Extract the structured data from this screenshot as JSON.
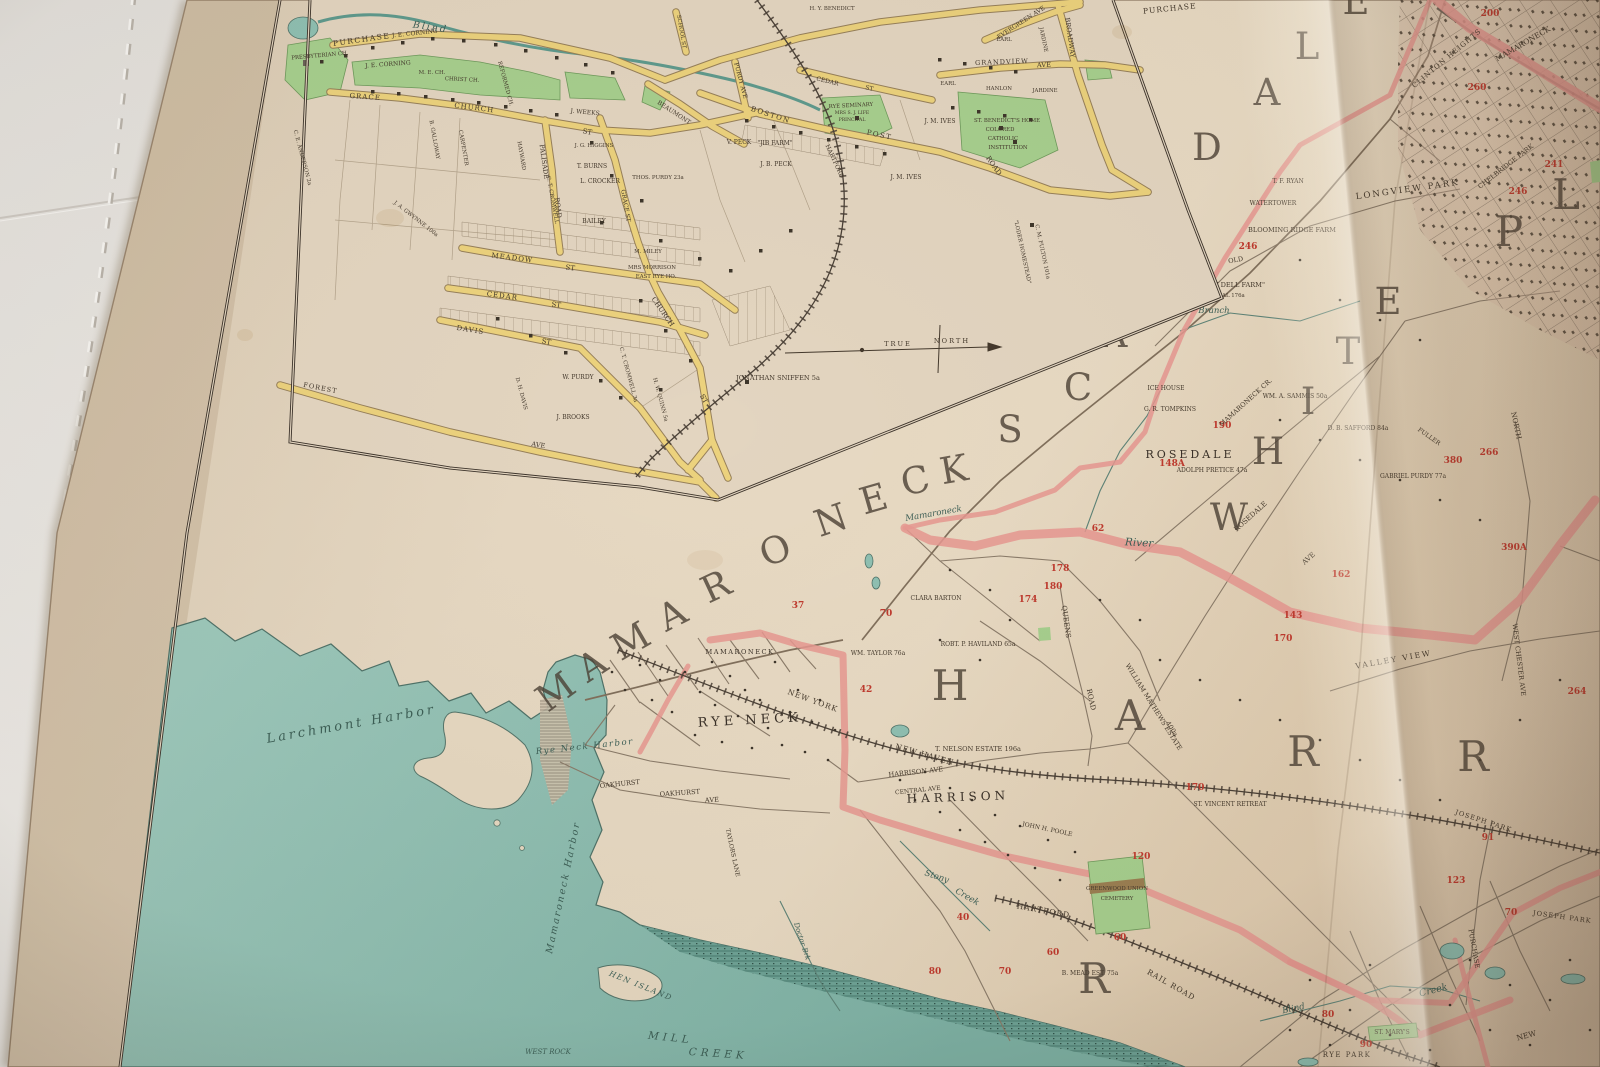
{
  "palette": {
    "sheet_white": "#e9e6e1",
    "page_cream": "#e5d7c1",
    "water_teal": "#93c2b4",
    "road_yellow": "#ecd27d",
    "park_green": "#a7cf8e",
    "boundary_pink": "#e69890",
    "ink": "#44392c",
    "plate_red": "#bf3a2e"
  },
  "inset": {
    "streets": [
      "PURCHASE",
      "PURCHASE",
      "GRACE",
      "CHURCH",
      "ST",
      "BEAUMONT",
      "PALISADE",
      "ROAD",
      "MEADOW",
      "ST",
      "CEDAR",
      "ST",
      "DAVIS",
      "ST",
      "FOREST",
      "AVE",
      "CHURCH",
      "ST",
      "GRACE ST",
      "BOSTON",
      "POST",
      "ROAD",
      "CEDAR",
      "ST",
      "PURDY AVE",
      "GRANDVIEW",
      "AVE",
      "EVERGREEN AVE",
      "BROADWAY",
      "HARTFORD",
      "SCHOOL ST"
    ],
    "places": [
      "PRESBYTERIAN CH.",
      "J. E. CORNING",
      "J. E. CORNING",
      "M. E. CH.",
      "CHRIST CH.",
      "REFORMED CH.",
      "J. WEEKS",
      "J. G. HIGGINS",
      "T. BURNS",
      "L. CROCKER",
      "BAILEY",
      "THOS. PURDY 23a",
      "C. T. CROMWELL",
      "HAYWARD",
      "CARPENTER",
      "B. GALLOWAY",
      "C. E. ANDERSON 2a",
      "J. A. GWYNNE 100a",
      "W. PURDY",
      "J. BROOKS",
      "D. H. DAVIS",
      "C. T. CROMWELL 3a",
      "H. W. QUINN 5a",
      "JONATHAN SNIFFEN 5a",
      "V. PECK",
      "\"JIB FARM\"",
      "J. B. PECK",
      "J. M. IVES",
      "J. M. IVES",
      "RYE SEMINARY",
      "MRS S. J. LIFE",
      "PRINCIPAL",
      "ST. BENEDICT'S HOME",
      "COLORED",
      "CATHOLIC",
      "INSTITUTION",
      "EARL",
      "EARL",
      "HANLON",
      "JARDINE",
      "JARDINE",
      "H. Y. BENEDICT",
      "\"LODER HOMESTEAD\"",
      "C. M. FULTON 101a",
      "M. MILEY",
      "MRS MORRISON",
      "EAST RYE HO.",
      "TRUE",
      "NORTH",
      "Blind"
    ]
  },
  "main": {
    "big": {
      "mamaroneck": [
        "M",
        "A",
        "M",
        "A",
        "R",
        "O",
        "N",
        "E",
        "C",
        "K"
      ],
      "scarsdale": [
        "S",
        "C",
        "A",
        "R",
        "S",
        "D",
        "A",
        "L",
        "E"
      ],
      "white": [
        "W",
        "H",
        "I",
        "T",
        "E"
      ],
      "plains": [
        "P",
        "L"
      ],
      "harrison": [
        "H",
        "A",
        "R",
        "R"
      ],
      "rye": [
        "R"
      ]
    },
    "towns": [
      "RYE NECK",
      "HARRISON",
      "ROSEDALE",
      "MAMARONECK"
    ],
    "water": [
      "Larchmont Harbor",
      "Rye Neck Harbor",
      "Mamaroneck Harbor",
      "MILL",
      "CREEK",
      "WEST ROCK",
      "HEN ISLAND",
      "Mamaroneck",
      "River",
      "Stony",
      "Creek",
      "Doctor Brk",
      "Blind",
      "Creek",
      "Branch",
      "MAMARONECK CR.",
      "MAMARONECK"
    ],
    "roads": [
      "NEW YORK",
      "NEW HAVEN",
      "HARTFORD",
      "RAIL ROAD",
      "NEW",
      "QUEENS",
      "ROAD",
      "ROSEDALE",
      "AVE",
      "VALLEY VIEW",
      "NORTH",
      "WEST CHESTER AVE",
      "PURCHASE",
      "OLD",
      "HARRISON AVE",
      "CENTRAL AVE",
      "OAKHURST",
      "OAKHURST",
      "AVE",
      "TAYLORS LANE"
    ],
    "places": [
      "LONGVIEW PARK",
      "CLINTON HEIGHTS",
      "CHELBRIDGE PARK",
      "BLOOMING RIDGE FARM",
      "WATERTOWER",
      "\"ROCKY DELL FARM\"",
      "MRS REVEAL 176a",
      "T. F. RYAN",
      "ICE HOUSE",
      "G. R. TOMPKINS",
      "ADOLPH PRETICE 47a",
      "WM. A. SAMMIS 50a",
      "D. B. SAFFORD 84a",
      "FULLER",
      "GABRIEL PURDY 77a",
      "CLARA BARTON",
      "WM. TAYLOR 76a",
      "ROBT. P. HAVILAND 65a",
      "T. NELSON ESTATE 196a",
      "WILLIAM MATHEWS ESTATE",
      "400a",
      "ST. VINCENT RETREAT",
      "JOHN H. POOLE",
      "GREENWOOD UNION",
      "CEMETERY",
      "B. MEAD EST. 75a",
      "ST. MARY'S",
      "RYE PARK",
      "JOSEPH PARK",
      "JOSEPH PARK"
    ],
    "reds": [
      "190",
      "148A",
      "62",
      "178",
      "180",
      "174",
      "70",
      "37",
      "42",
      "143",
      "170",
      "162",
      "246",
      "200",
      "260",
      "380",
      "266",
      "390A",
      "264",
      "241",
      "246",
      "120",
      "60",
      "60",
      "70",
      "80",
      "40",
      "80",
      "90",
      "70",
      "123",
      "91",
      "170"
    ]
  }
}
